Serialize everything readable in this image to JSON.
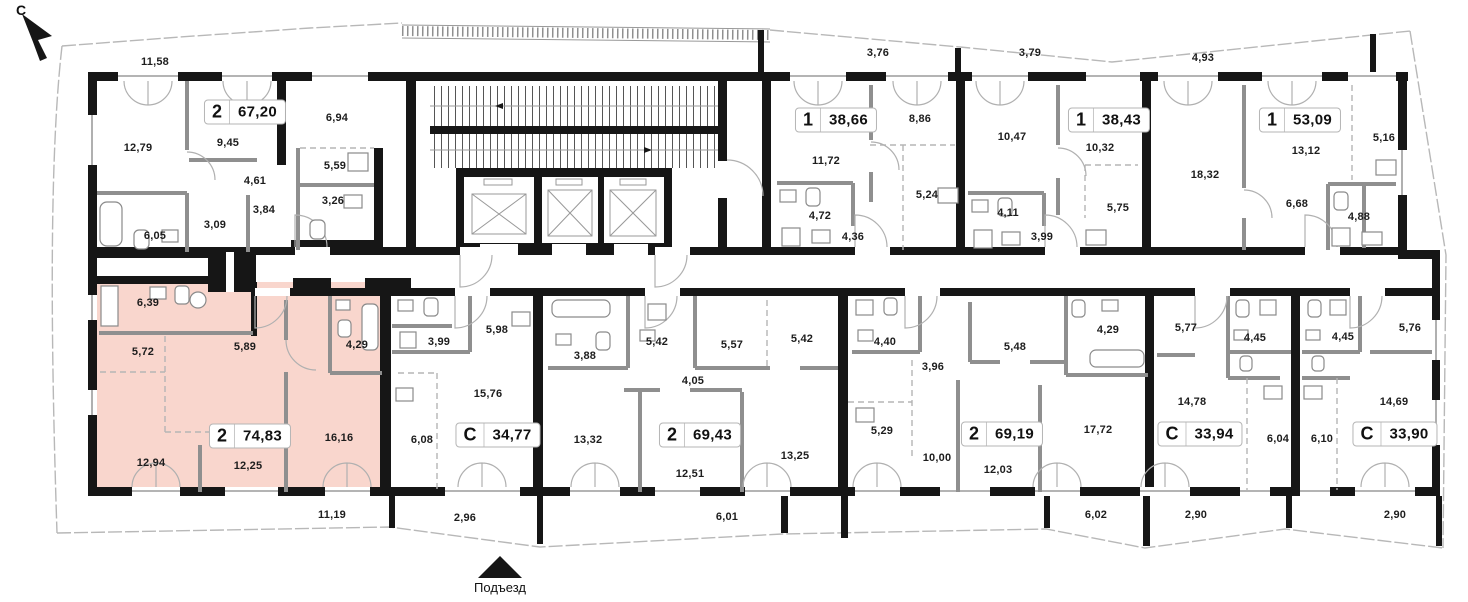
{
  "plan": {
    "north_label": "С",
    "entrance_label": "Подъезд"
  },
  "colors": {
    "highlight": "#f9d6cd"
  },
  "apartments": [
    {
      "type": "2",
      "area": "67,20",
      "highlighted": false,
      "rooms": [
        "11,58",
        "12,79",
        "9,45",
        "6,94",
        "4,61",
        "5,59",
        "3,26",
        "3,84",
        "3,09",
        "6,05"
      ]
    },
    {
      "type": "1",
      "area": "38,66",
      "highlighted": false,
      "rooms": [
        "3,76",
        "11,72",
        "8,86",
        "5,24",
        "4,72",
        "4,36"
      ]
    },
    {
      "type": "1",
      "area": "38,43",
      "highlighted": false,
      "rooms": [
        "3,79",
        "10,47",
        "10,32",
        "5,75",
        "4,11",
        "3,99"
      ]
    },
    {
      "type": "1",
      "area": "53,09",
      "highlighted": false,
      "rooms": [
        "4,93",
        "18,32",
        "13,12",
        "5,16",
        "6,68",
        "4,88"
      ]
    },
    {
      "type": "2",
      "area": "74,83",
      "highlighted": true,
      "rooms": [
        "6,39",
        "5,72",
        "5,89",
        "4,29",
        "12,94",
        "12,25",
        "16,16",
        "11,19"
      ]
    },
    {
      "type": "С",
      "area": "34,77",
      "highlighted": false,
      "rooms": [
        "3,99",
        "5,98",
        "15,76",
        "6,08",
        "2,96"
      ]
    },
    {
      "type": "2",
      "area": "69,43",
      "highlighted": false,
      "rooms": [
        "3,88",
        "5,42",
        "5,57",
        "5,42",
        "4,05",
        "13,32",
        "12,51",
        "13,25",
        "6,01"
      ]
    },
    {
      "type": "2",
      "area": "69,19",
      "highlighted": false,
      "rooms": [
        "4,40",
        "3,96",
        "5,29",
        "10,00",
        "12,03",
        "5,48",
        "4,29",
        "17,72",
        "6,02"
      ]
    },
    {
      "type": "С",
      "area": "33,94",
      "highlighted": false,
      "rooms": [
        "5,77",
        "14,78",
        "4,45",
        "6,04",
        "2,90"
      ]
    },
    {
      "type": "С",
      "area": "33,90",
      "highlighted": false,
      "rooms": [
        "4,45",
        "5,76",
        "14,69",
        "6,10",
        "2,90"
      ]
    }
  ]
}
